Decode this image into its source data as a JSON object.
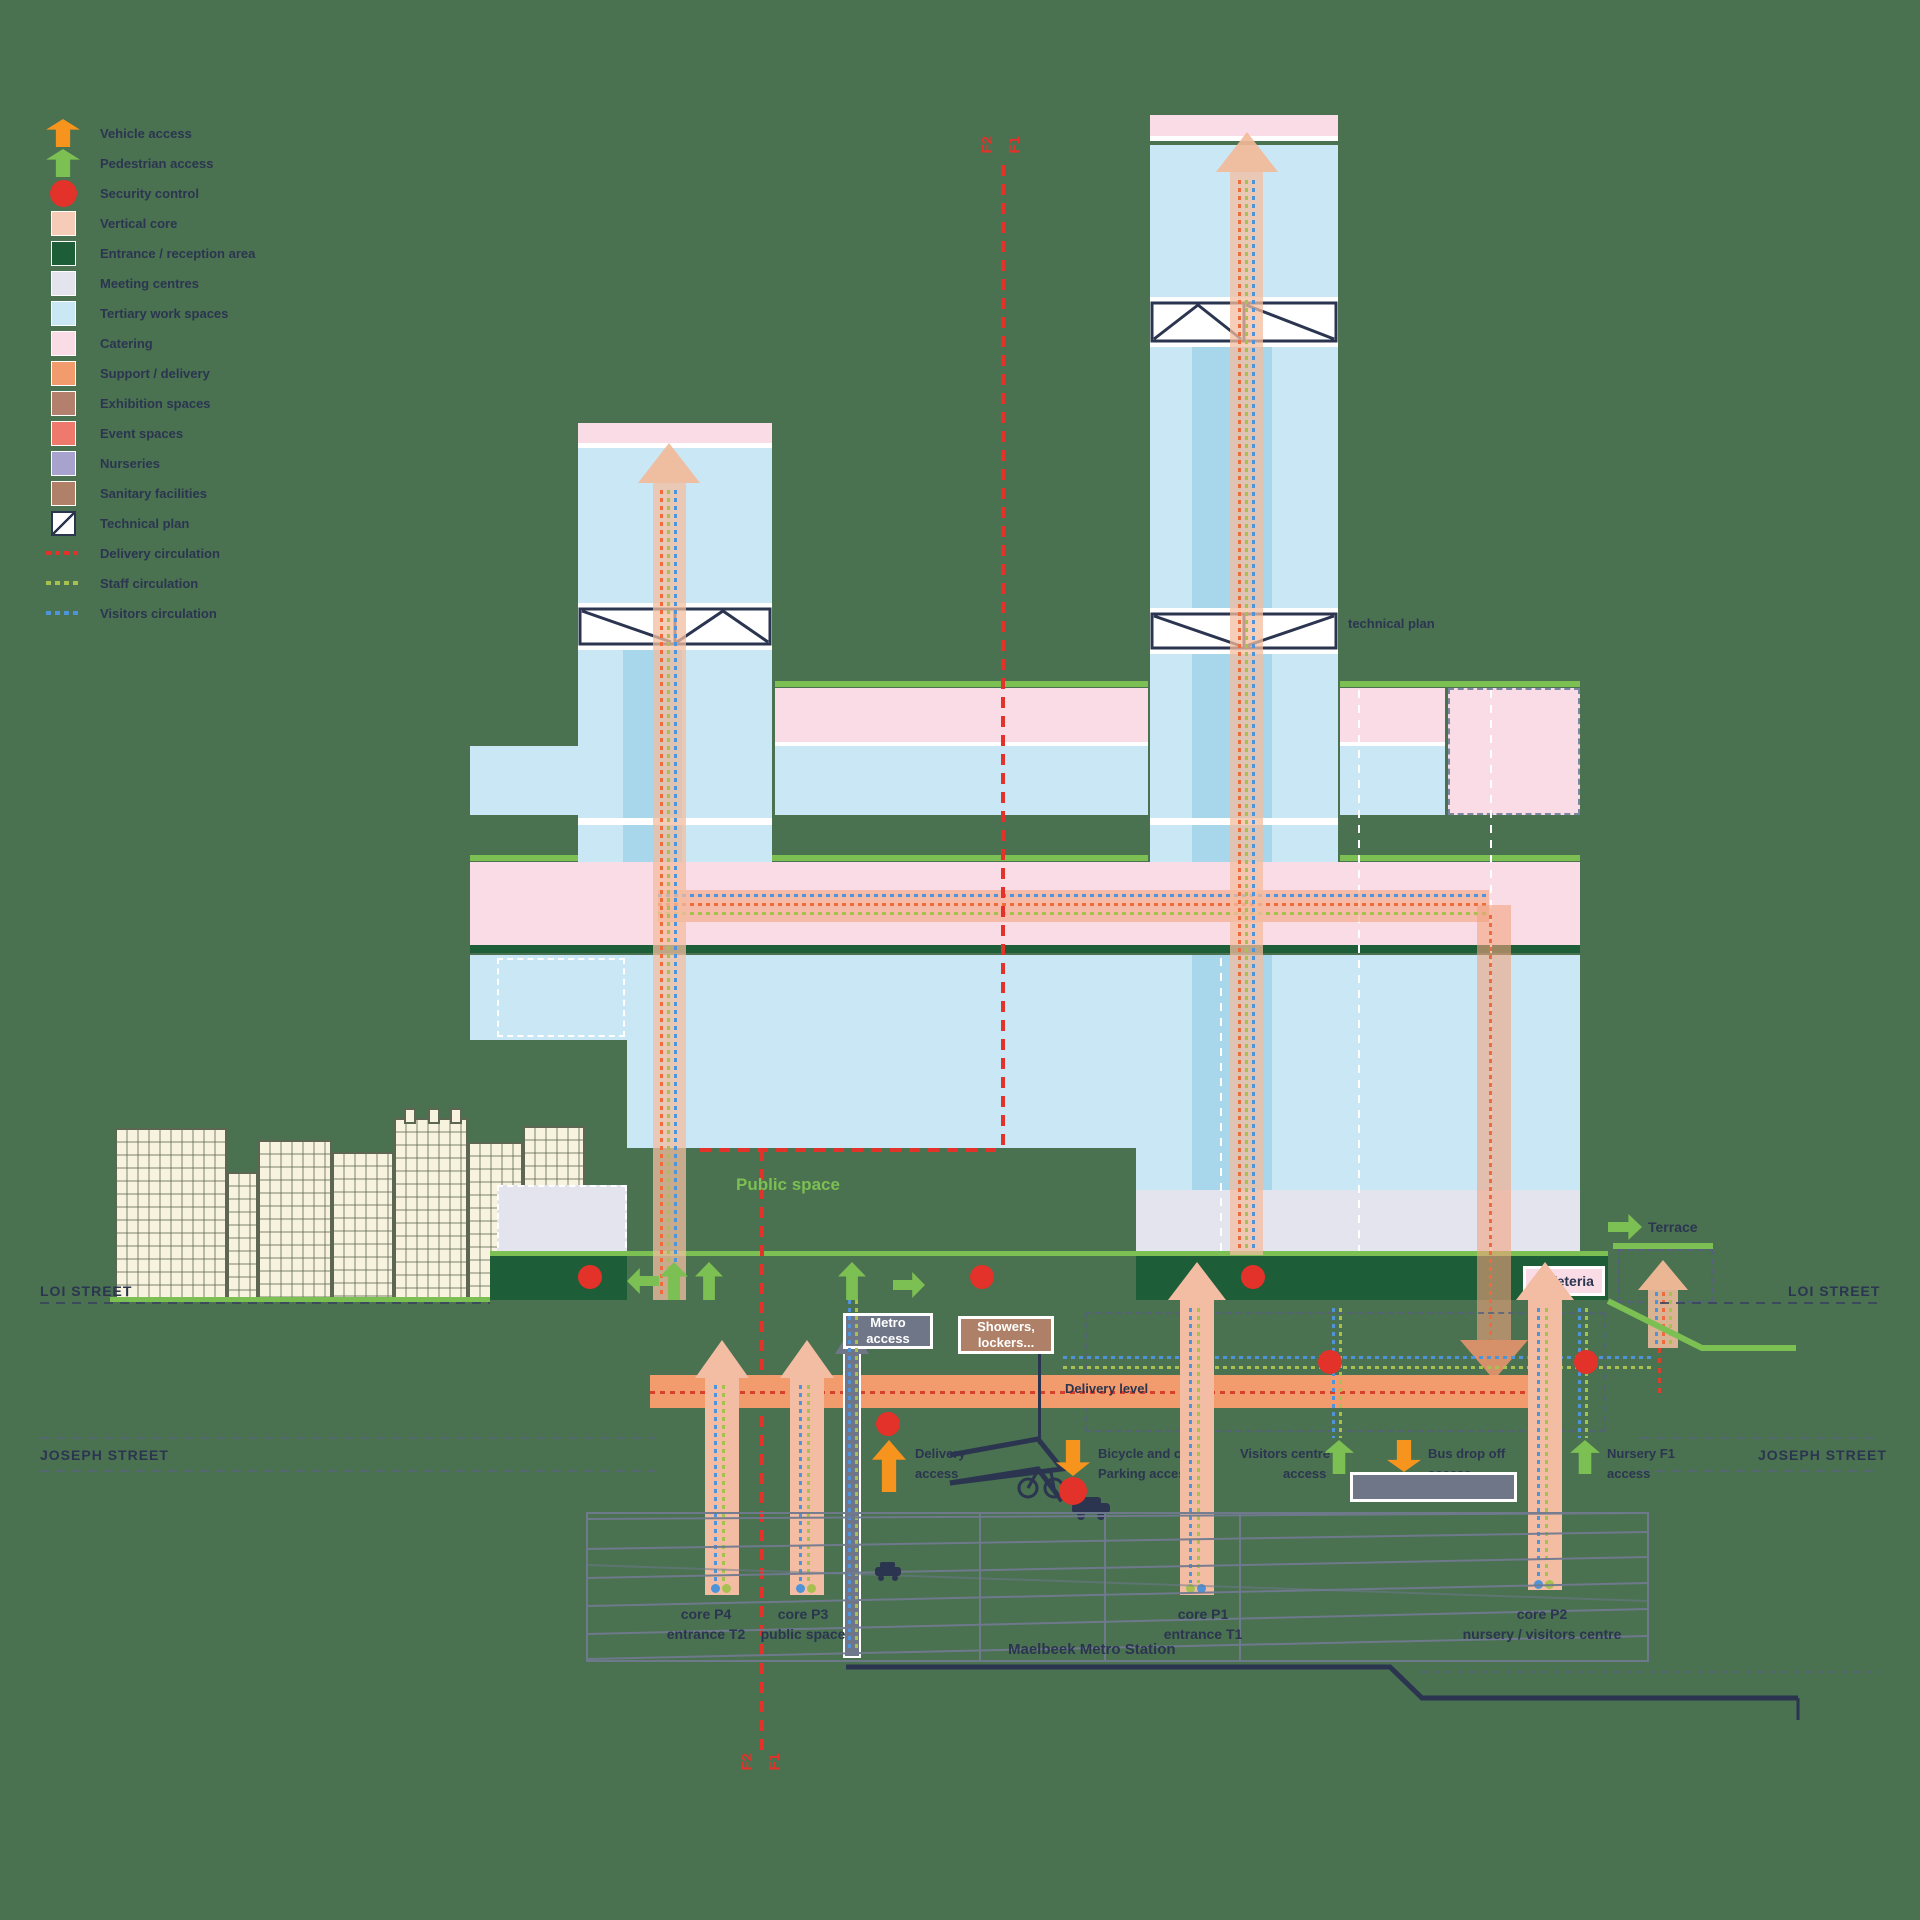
{
  "colors": {
    "background": "#4a7150",
    "navy_text": "#2b3550",
    "bright_green": "#7cbf53",
    "vehicle_orange": "#f7941e",
    "security_red": "#e2322a",
    "vertical_core": "#f6ccb8",
    "entrance_reception": "#1d5d38",
    "meeting_centres": "#e4e4ef",
    "tertiary_work": "#c9e7f4",
    "tertiary_inner": "#a8d7eb",
    "catering_pink": "#fadce7",
    "support_delivery": "#f29b6d",
    "exhibition": "#b3806d",
    "event": "#f0796d",
    "nurseries": "#a8a2cf",
    "sanitary": "#b08168",
    "staff_circulation": "#a8c050",
    "visitors_circulation": "#4f93d8",
    "metro_grey": "#6e7687",
    "showers_brown": "#ae8068",
    "facade_cream": "#f8f3df"
  },
  "legend": {
    "items": [
      {
        "icon": "arrow-up-orange",
        "label": "Vehicle access"
      },
      {
        "icon": "arrow-up-green",
        "label": "Pedestrian access"
      },
      {
        "icon": "circle-red",
        "label": "Security control"
      },
      {
        "swatch": "#f6ccb8",
        "label": "Vertical core"
      },
      {
        "swatch": "#1d5d38",
        "label": "Entrance / reception area"
      },
      {
        "swatch": "#e4e4ef",
        "label": "Meeting centres"
      },
      {
        "swatch": "#c9e7f4",
        "label": "Tertiary work spaces"
      },
      {
        "swatch": "#fadce7",
        "label": "Catering"
      },
      {
        "swatch": "#f29b6d",
        "label": "Support / delivery"
      },
      {
        "swatch": "#b3806d",
        "label": "Exhibition spaces"
      },
      {
        "swatch": "#f0796d",
        "label": "Event spaces"
      },
      {
        "swatch": "#a8a2cf",
        "label": "Nurseries"
      },
      {
        "swatch": "#b08168",
        "label": "Sanitary facilities"
      },
      {
        "icon": "technical",
        "label": "Technical plan"
      },
      {
        "icon": "line-red",
        "label": "Delivery circulation"
      },
      {
        "icon": "line-green",
        "label": "Staff circulation"
      },
      {
        "icon": "line-blue",
        "label": "Visitors circulation"
      }
    ]
  },
  "section_markers": {
    "top": {
      "left": "F2",
      "right": "F1"
    },
    "bottom": {
      "left": "F2",
      "right": "F1"
    }
  },
  "labels": {
    "technical_plan": "technical plan",
    "public_space": "Public space",
    "delivery_level": "Delivery level",
    "terrace": "Terrace",
    "cafeteria": "Cafeteria",
    "metro_access": [
      "Metro",
      "access"
    ],
    "showers_lockers": [
      "Showers,",
      "lockers..."
    ],
    "delivery_access": [
      "Delivery",
      "access"
    ],
    "bicycle_parking": [
      "Bicycle and car",
      "Parking access"
    ],
    "visitors_centre": [
      "Visitors centre",
      "access"
    ],
    "bus_drop_off": [
      "Bus drop off",
      "access"
    ],
    "nursery_access": [
      "Nursery F1",
      "access"
    ],
    "metro_station": "Maelbeek Metro Station"
  },
  "streets": {
    "loi_left": "LOI  STREET",
    "loi_right": "LOI  STREET",
    "joseph_left": "JOSEPH STREET",
    "joseph_right": "JOSEPH STREET"
  },
  "cores": [
    {
      "name": "core P4",
      "sub": "entrance T2"
    },
    {
      "name": "core P3",
      "sub": "public space"
    },
    {
      "name": "core P1",
      "sub": "entrance T1"
    },
    {
      "name": "core P2",
      "sub": "nursery / visitors centre"
    }
  ]
}
